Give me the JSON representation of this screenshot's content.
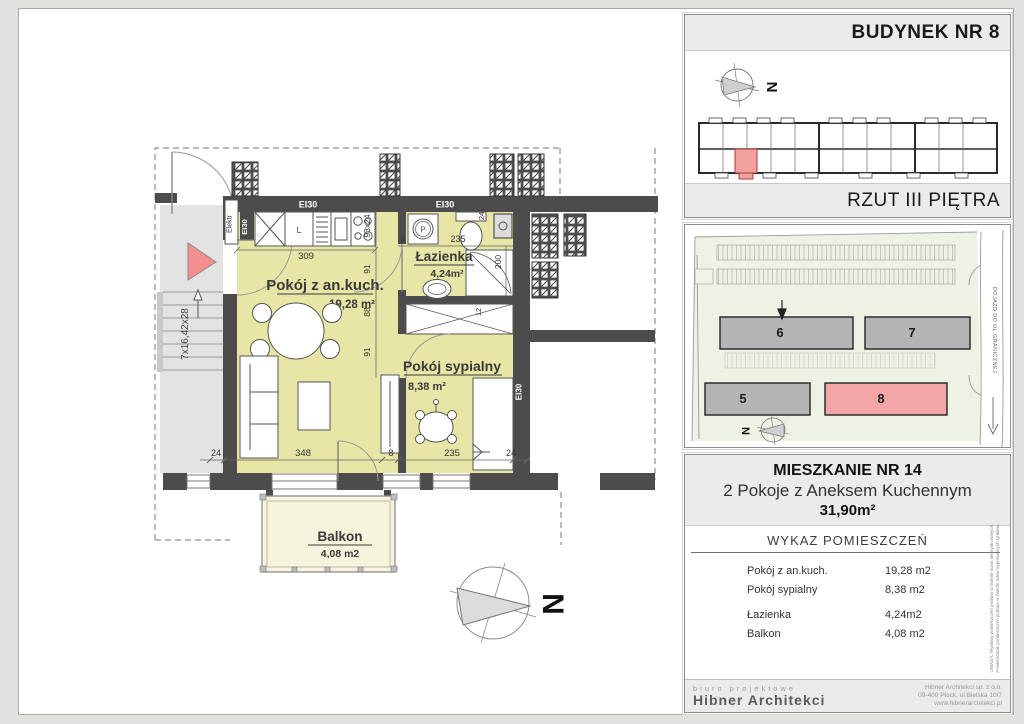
{
  "plan": {
    "rooms": {
      "living": {
        "name": "Pokój z an.kuch.",
        "area": "19,28 m²"
      },
      "bath": {
        "name": "Łazienka",
        "area": "4,24m²"
      },
      "bedroom": {
        "name": "Pokój sypialny",
        "area": "8,38 m²"
      },
      "balcony": {
        "name": "Balkon",
        "area": "4,08 m2"
      }
    },
    "labels": {
      "fire_rating": "EI30",
      "electrical": "Elektr",
      "stairs": "7x16,42x28",
      "north": "N",
      "washer": "P",
      "fridge": "L"
    },
    "dims": {
      "kitchen_width": "309",
      "kitchen_chain": "93x24",
      "chain_91a": "91",
      "chain_88": "88",
      "chain_91b": "91",
      "bath_gap": "8",
      "bath_width": "235",
      "bath_depth": "200",
      "toilet_24": "24",
      "wardrobe_12": "12",
      "bottom": [
        "24",
        "348",
        "8",
        "235",
        "24"
      ]
    }
  },
  "panel_building": {
    "title": "BUDYNEK NR 8",
    "subtitle": "RZUT III PIĘTRA",
    "north": "N"
  },
  "panel_site": {
    "buildings": [
      "5",
      "6",
      "7",
      "8"
    ],
    "road": "DOJAZD DO UL.GRANICZNEJ",
    "north": "N"
  },
  "panel_info": {
    "title": "MIESZKANIE NR 14",
    "subtitle": "2 Pokoje z Aneksem Kuchennym",
    "total_area": "31,90m²",
    "table_title": "WYKAZ POMIESZCZEŃ",
    "rows": [
      {
        "label": "Pokój z an.kuch.",
        "value": "19,28 m2"
      },
      {
        "label": "Pokój sypialny",
        "value": "8,38 m2"
      },
      {
        "label": "Łazienka",
        "value": "4,24m2"
      },
      {
        "label": "Balkon",
        "value": "4,08 m2"
      }
    ],
    "note_line1": "UWAGA: Wymiary pomieszczeń podano w świetle ścian nieotynkowanych.",
    "note_line2": "Powierzchnie pomieszczeń podano w świetle ścian wyprawionych tynkiem.",
    "footer": {
      "left_top": "biuro projektowe",
      "left_bottom": "Hibner Architekci",
      "right_lines": [
        "Hibner Architekci sp. z o.o.",
        "09-400 Płock, ul.Bielska 10/7",
        "www.hibnerarchitekci.pl"
      ]
    }
  }
}
